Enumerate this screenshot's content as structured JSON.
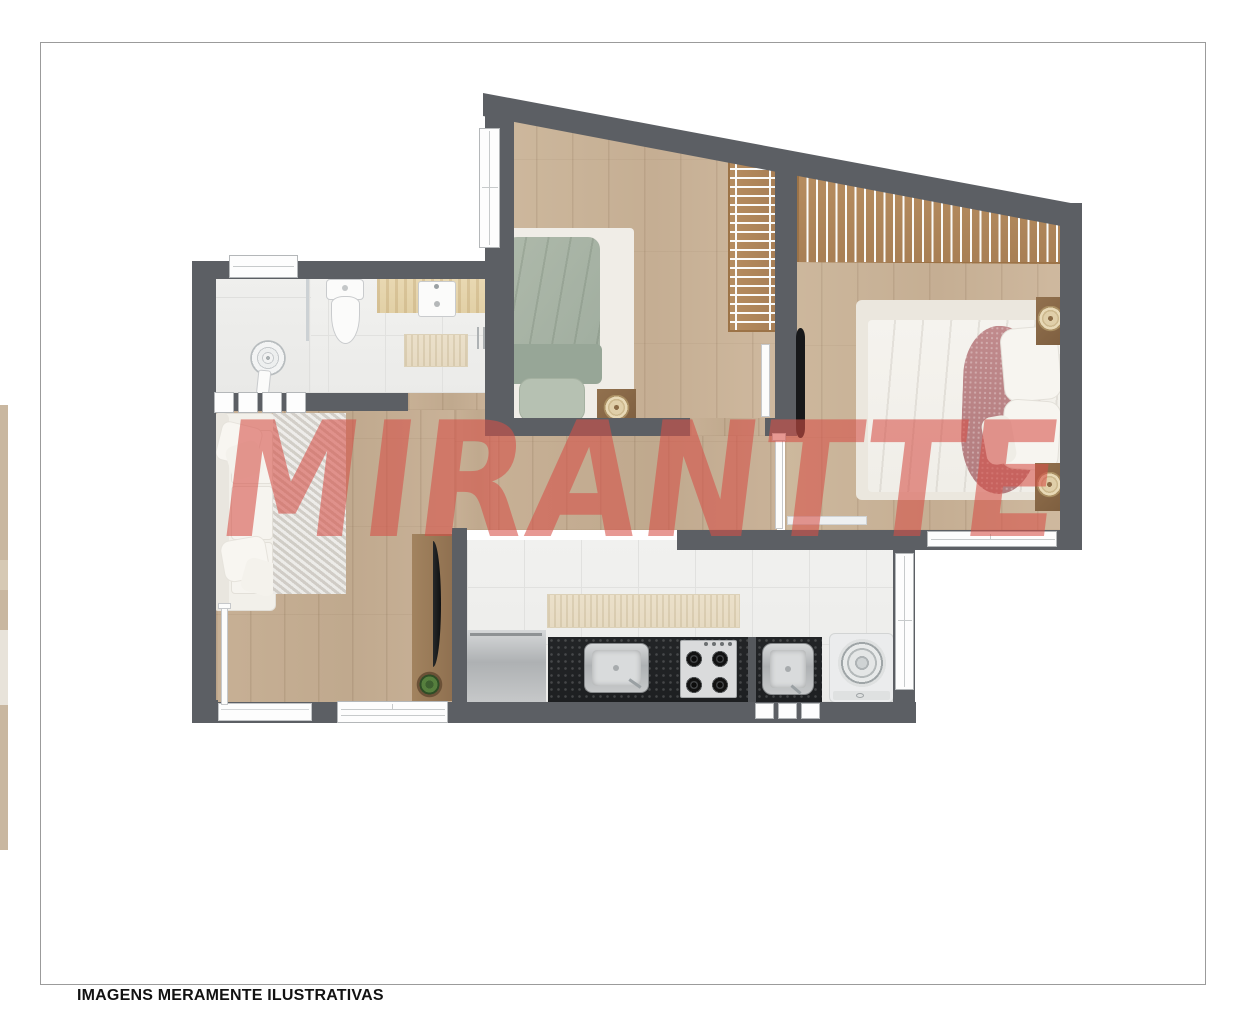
{
  "image": {
    "watermark_text": "MIRANTTE",
    "disclaimer_text": "IMAGENS MERAMENTE ILUSTRATIVAS"
  },
  "colors": {
    "wall_gray": "#5C5F64",
    "wood_floor": "#C5AE93",
    "tile_floor": "#F0F0EE",
    "granite_counter": "#212325",
    "travertine_counter": "#E6D5AD",
    "single_bed_sage": "#A9B6A6",
    "slat_panel_wood": "#B0895E",
    "watermark_red": "#D55046",
    "page_frame_gray": "#9B9B9B"
  }
}
